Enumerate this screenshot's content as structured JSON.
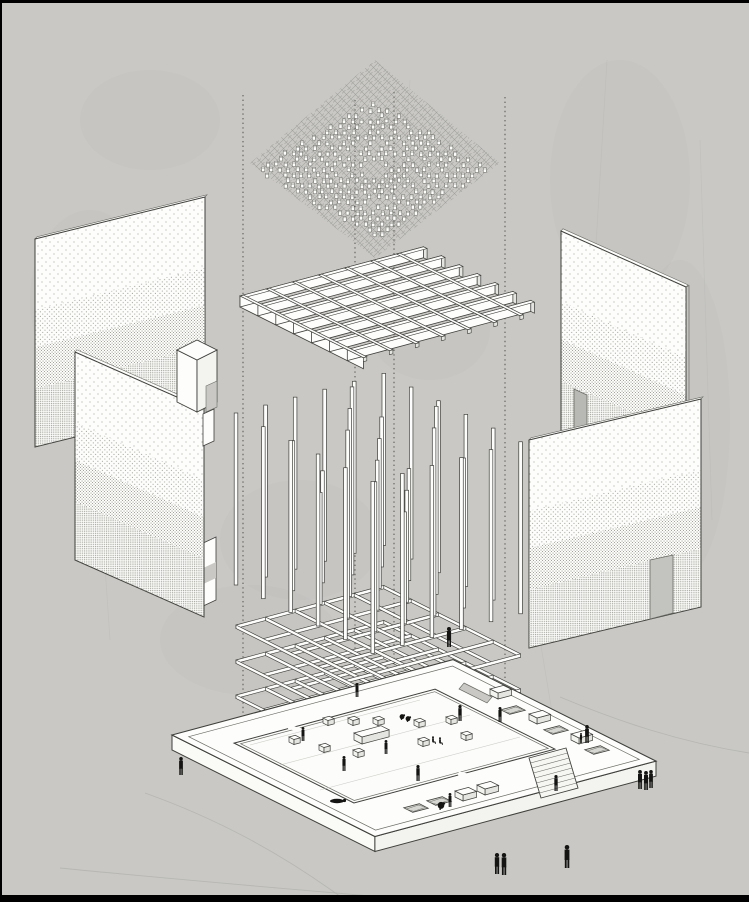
{
  "canvas": {
    "width": 749,
    "height": 902,
    "background": "#c9c8c5"
  },
  "frame": {
    "color": "#000000",
    "top": 3,
    "left": 2,
    "bottom": 7
  },
  "palette": {
    "line": "#3f3f3c",
    "line_soft": "#6b6b66",
    "white": "#fdfdfb",
    "white_dim": "#f3f3ef",
    "shade": "#e4e4e0",
    "shade_deep": "#d6d6d2",
    "hatch": "#8e8e88",
    "dot": "#8d8d86",
    "figure": "#141412",
    "guide": "#4a4a45",
    "ground_line": "#b2b2ae",
    "court_line": "#c2c2be",
    "opening": "#bdbdb8"
  },
  "axes": {
    "u": [
      0.966,
      -0.259
    ],
    "v": [
      0.894,
      0.447
    ]
  },
  "guides": [
    {
      "x": 243,
      "y1": 95,
      "y2": 714
    },
    {
      "x": 355,
      "y1": 100,
      "y2": 780
    },
    {
      "x": 394,
      "y1": 92,
      "y2": 792
    },
    {
      "x": 505,
      "y1": 97,
      "y2": 716
    }
  ],
  "ground_curves": [
    "M 560,697 C 620,722 680,742 749,753",
    "M 145,793 C 215,818 280,852 345,900",
    "M 60,868 C 180,880 300,890 430,901"
  ],
  "texture": {
    "blobs": [
      [
        90,
        300,
        60,
        90
      ],
      [
        620,
        180,
        70,
        120
      ],
      [
        680,
        420,
        50,
        160
      ],
      [
        300,
        540,
        80,
        60
      ],
      [
        150,
        120,
        70,
        50
      ],
      [
        430,
        330,
        60,
        50
      ],
      [
        250,
        640,
        90,
        55
      ]
    ],
    "streaks": [
      [
        607,
        60,
        585,
        430
      ],
      [
        700,
        140,
        712,
        520
      ],
      [
        95,
        420,
        110,
        640
      ],
      [
        540,
        640,
        560,
        760
      ],
      [
        410,
        80,
        400,
        220
      ]
    ]
  },
  "canopy": {
    "hatch_diamond": [
      [
        375,
        60
      ],
      [
        500,
        163
      ],
      [
        375,
        258
      ],
      [
        250,
        163
      ]
    ],
    "cluster": {
      "cx": 374,
      "cy": 172,
      "rx": 118,
      "ry": 70,
      "step_x": 8.5,
      "step_y": 5.4,
      "block_w": 3.1,
      "block_h": 4.6,
      "skip": 0.2,
      "hole": 0.15,
      "seed": 7
    }
  },
  "waffle": {
    "origin": [
      240,
      296
    ],
    "joists": {
      "count": 7,
      "spacing": 20,
      "length": 190,
      "depth": 11,
      "flange": 4
    },
    "ribs": {
      "count": 7,
      "spacing": 27,
      "length": 120,
      "extension": 18,
      "width": 3.6,
      "cap": 4
    }
  },
  "lattice": {
    "origin": [
      236,
      585
    ],
    "bays": 5,
    "spacing": 30.6,
    "column_width": 3.6,
    "beam_depth": 3.4,
    "beam_levels": [
      40,
      75,
      110,
      145
    ],
    "outer_top": 172,
    "inner_tops": [
      112,
      150,
      188
    ]
  },
  "plaza": {
    "origin": [
      172,
      735
    ],
    "u_len": 291,
    "v_len": 227,
    "thickness": 15,
    "inset": 9,
    "court": {
      "off_u": 31,
      "off_v": 36,
      "u_len": 208,
      "v_len": 134,
      "curb_inset": 3.5
    },
    "notch": [
      [
        464,
        683
      ],
      [
        492,
        697
      ],
      [
        487,
        703
      ],
      [
        459,
        689
      ]
    ],
    "stairs": {
      "quad": [
        [
          529,
          758
        ],
        [
          566,
          748
        ],
        [
          578,
          788
        ],
        [
          541,
          798
        ]
      ],
      "steps": 7
    },
    "pits": [
      [
        513,
        710
      ],
      [
        556,
        730
      ],
      [
        597,
        750
      ],
      [
        416,
        808
      ],
      [
        439,
        801
      ]
    ],
    "boxes": [
      [
        536,
        719
      ],
      [
        578,
        739
      ],
      [
        497,
        694
      ],
      [
        462,
        796
      ],
      [
        484,
        790
      ]
    ],
    "cubes": [
      [
        327,
        723
      ],
      [
        293,
        742
      ],
      [
        323,
        750
      ],
      [
        352,
        723
      ],
      [
        377,
        723
      ],
      [
        418,
        725
      ],
      [
        422,
        744
      ],
      [
        357,
        755
      ],
      [
        450,
        722
      ],
      [
        465,
        738
      ]
    ],
    "bench": {
      "anchor": [
        354,
        733
      ],
      "u": 28,
      "v": 9,
      "h": 7
    },
    "floor_lines": [
      [
        250,
        745,
        420,
        700
      ],
      [
        280,
        765,
        470,
        715
      ],
      [
        320,
        790,
        520,
        737
      ]
    ]
  },
  "panels": {
    "band_stops": [
      0,
      0.34,
      0.52,
      0.72,
      1
    ],
    "rear_left": {
      "corners": [
        [
          35,
          239
        ],
        [
          205,
          197
        ],
        [
          205,
          405
        ],
        [
          35,
          447
        ]
      ]
    },
    "front_left": {
      "corners": [
        [
          75,
          352
        ],
        [
          204,
          409
        ],
        [
          204,
          617
        ],
        [
          75,
          560
        ]
      ]
    },
    "rear_right": {
      "corners": [
        [
          561,
          231
        ],
        [
          686,
          287
        ],
        [
          686,
          495
        ],
        [
          561,
          439
        ]
      ],
      "door": [
        [
          574,
          389
        ],
        [
          587,
          395
        ],
        [
          587,
          442
        ],
        [
          574,
          436
        ]
      ]
    },
    "front_right": {
      "corners": [
        [
          529,
          440
        ],
        [
          701,
          399
        ],
        [
          701,
          607
        ],
        [
          529,
          648
        ]
      ],
      "door": [
        [
          650,
          560
        ],
        [
          673,
          555
        ],
        [
          673,
          613
        ],
        [
          650,
          619
        ]
      ]
    }
  },
  "vestibule": {
    "top": [
      [
        177,
        350
      ],
      [
        197,
        340
      ],
      [
        217,
        350
      ],
      [
        197,
        360
      ]
    ],
    "left": [
      [
        177,
        350
      ],
      [
        197,
        360
      ],
      [
        197,
        412
      ],
      [
        177,
        402
      ]
    ],
    "right": [
      [
        197,
        360
      ],
      [
        217,
        350
      ],
      [
        217,
        402
      ],
      [
        197,
        412
      ]
    ],
    "notch": [
      [
        206,
        386
      ],
      [
        217,
        381
      ],
      [
        217,
        407
      ],
      [
        206,
        412
      ]
    ],
    "tab": [
      [
        203,
        414
      ],
      [
        214,
        409
      ],
      [
        214,
        441
      ],
      [
        203,
        446
      ]
    ]
  },
  "jamb_tab": {
    "strip": [
      [
        199,
        545
      ],
      [
        216,
        537
      ],
      [
        216,
        600
      ],
      [
        199,
        608
      ]
    ],
    "notch": [
      [
        199,
        570
      ],
      [
        216,
        562
      ],
      [
        216,
        578
      ],
      [
        199,
        586
      ]
    ]
  },
  "figures": [
    [
      357,
      697,
      14,
      "stand"
    ],
    [
      303,
      741,
      14,
      "stand"
    ],
    [
      344,
      771,
      15,
      "stand"
    ],
    [
      386,
      754,
      14,
      "stand"
    ],
    [
      418,
      781,
      16,
      "stand"
    ],
    [
      460,
      721,
      16,
      "stand"
    ],
    [
      500,
      722,
      15,
      "stand"
    ],
    [
      402,
      720,
      8,
      "bend"
    ],
    [
      408,
      722,
      8,
      "bend"
    ],
    [
      433,
      744,
      8,
      "sit"
    ],
    [
      440,
      745,
      8,
      "sit"
    ],
    [
      337,
      803,
      5,
      "lie"
    ],
    [
      181,
      775,
      18,
      "stand"
    ],
    [
      587,
      743,
      18,
      "stand"
    ],
    [
      581,
      743,
      10,
      "stand"
    ],
    [
      556,
      791,
      16,
      "stand"
    ],
    [
      640,
      789,
      19,
      "stand"
    ],
    [
      646,
      790,
      19,
      "stand"
    ],
    [
      651,
      788,
      18,
      "stand"
    ],
    [
      449,
      647,
      20,
      "stand"
    ],
    [
      441,
      810,
      11,
      "bend"
    ],
    [
      450,
      807,
      14,
      "stand"
    ],
    [
      497,
      874,
      21,
      "stand"
    ],
    [
      504,
      875,
      22,
      "stand"
    ],
    [
      567,
      868,
      23,
      "stand"
    ]
  ]
}
